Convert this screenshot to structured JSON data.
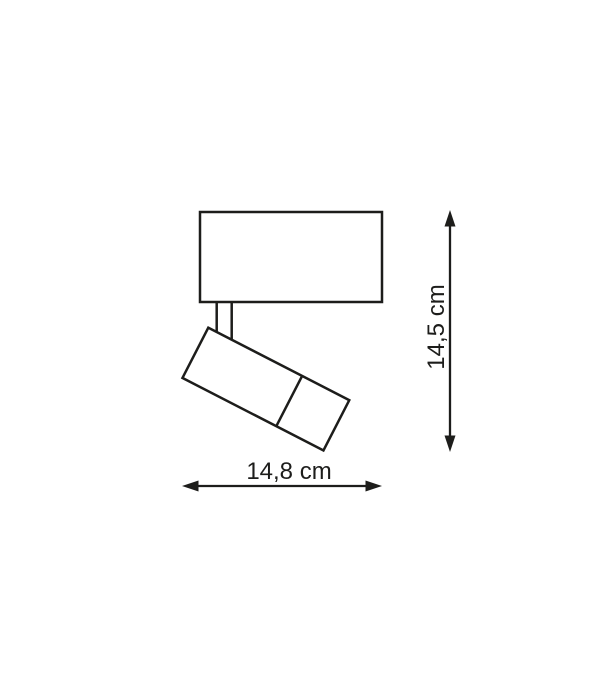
{
  "diagram": {
    "title": "spotlight-dimension-drawing",
    "height_label": "14,5 cm",
    "width_label": "14,8 cm",
    "colors": {
      "line": "#1d1d1b",
      "background": "#ffffff"
    }
  }
}
